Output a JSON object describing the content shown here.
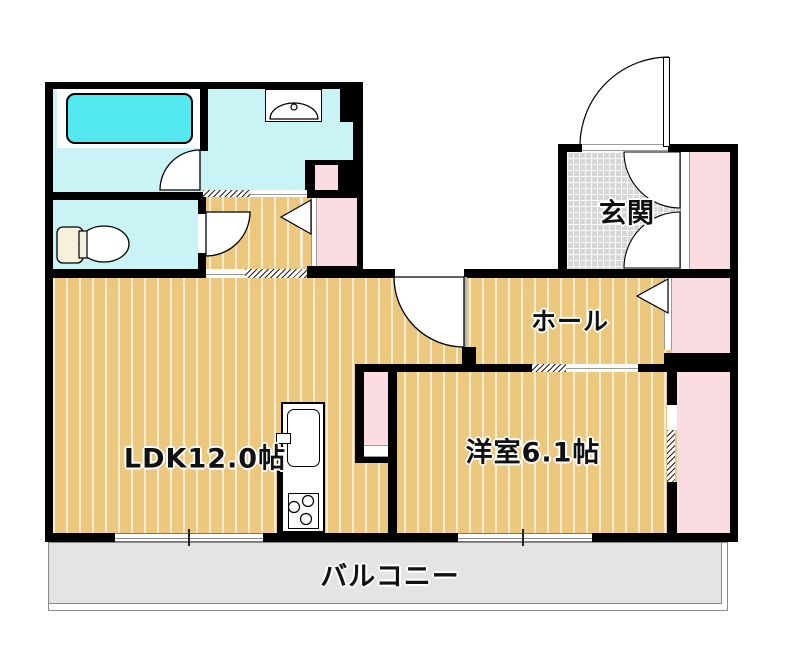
{
  "floorplan": {
    "rooms": {
      "entrance": {
        "label": "玄関"
      },
      "hall": {
        "label": "ホール"
      },
      "ldk": {
        "label": "LDK12.0帖"
      },
      "western_room": {
        "label": "洋室6.1帖"
      },
      "balcony": {
        "label": "バルコニー"
      }
    },
    "colors": {
      "wall": "#000000",
      "wood_floor": "#ebc87d",
      "wood_stripe": "#f7eccf",
      "wet_floor": "#c9f3f5",
      "bathtub": "#53e8ee",
      "closet_pink": "#fbdce1",
      "tile_gray": "#d6d6d6",
      "balcony_gray": "#e4e4e4",
      "toilet_tank": "#f6f1dc"
    }
  }
}
